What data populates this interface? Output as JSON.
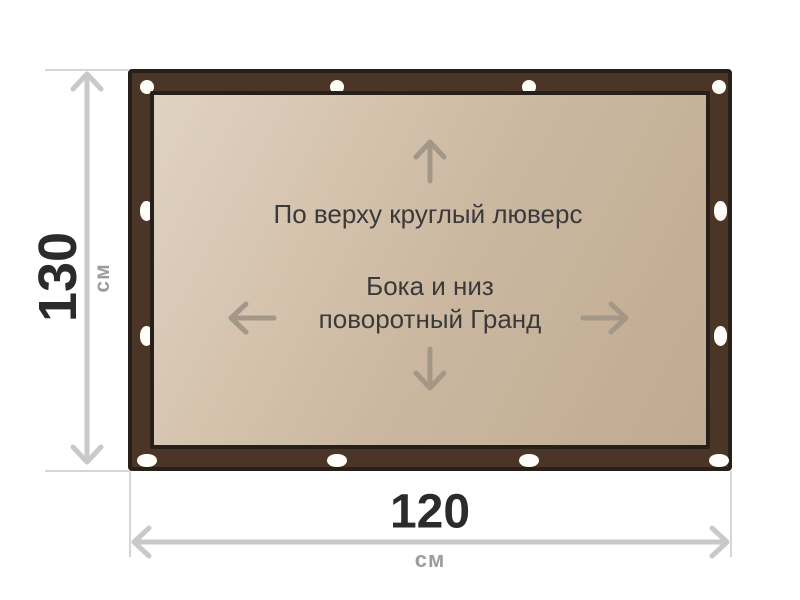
{
  "banner": {
    "notes": {
      "top": "По верху круглый люверс",
      "center_line1": "Бока и низ",
      "center_line2": "поворотный Гранд"
    },
    "grommets": {
      "top_shape": "round-eyelet",
      "sides_bottom_shape": "oval-slot",
      "top_count": 4,
      "bottom_count": 4,
      "left_count": 2,
      "right_count": 2
    }
  },
  "dimensions": {
    "height": {
      "value": "130",
      "unit": "см"
    },
    "width": {
      "value": "120",
      "unit": "см"
    }
  },
  "icons": {
    "arrow_up": "↑",
    "arrow_down": "↓",
    "arrow_left": "←",
    "arrow_right": "→",
    "grommet": "○",
    "dimension_height": "↕",
    "dimension_width": "↔"
  },
  "colors": {
    "frame": "#4a3526",
    "frame_outline": "#261f1a",
    "panel_light": "#e0d2c2",
    "panel_dark": "#c0aa90",
    "panel_arrow": "#a39888",
    "panel_text": "#3a3a3a",
    "dim_number": "#2b2b2b",
    "dim_unit": "#9c9c9c",
    "dim_line": "#c9c9c9",
    "grommet_fill": "#fffdf8",
    "background": "#ffffff"
  }
}
